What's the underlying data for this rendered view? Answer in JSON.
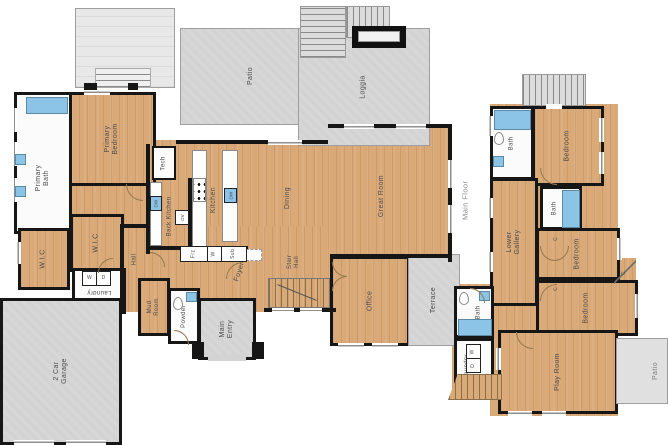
{
  "left": {
    "floor_label": "Main Floor",
    "patio": "Patio",
    "loggia": "Loggia",
    "primary_bedroom": "Primary Bedroom",
    "primary_bath": "Primary Bath",
    "wic_a": "W.I.C",
    "wic_b": "W.I.C",
    "laundry": "Laundry",
    "hall": "Hall",
    "tech": "Tech",
    "back_kitchen": "Back Kitchen",
    "kitchen": "Kitchen",
    "dining": "Dining",
    "great_room": "Great Room",
    "foyer": "Foyer",
    "stair_hall": "Stair Hall",
    "office": "Office",
    "terrace": "Terrace",
    "mud_room": "Mud Room",
    "powder": "Powder",
    "main_entry": "Main Entry",
    "garage": "2 Car Garage"
  },
  "right": {
    "bath_upper": "Bath",
    "bedroom_upper": "Bedroom",
    "bath_mid": "Bath",
    "lower_gallery": "Lower Gallery",
    "bedroom_mid": "Bedroom",
    "bedroom_lower": "Bedroom",
    "bath_lower": "Bath",
    "laundry": "Laundry",
    "play_room": "Play Room",
    "patio": "Patio"
  },
  "fixtures": {
    "dw": "DW",
    "ov": "OV",
    "washer": "W",
    "dryer": "D",
    "freezer": "Frz",
    "wine": "W",
    "subzero": "Sub",
    "closet": "C"
  },
  "colors": {
    "wood": "#d9a978",
    "concrete": "#d3d3d3",
    "wall": "#161616",
    "fixture_blue": "#8cc4e8",
    "label": "#4b4b4b"
  }
}
